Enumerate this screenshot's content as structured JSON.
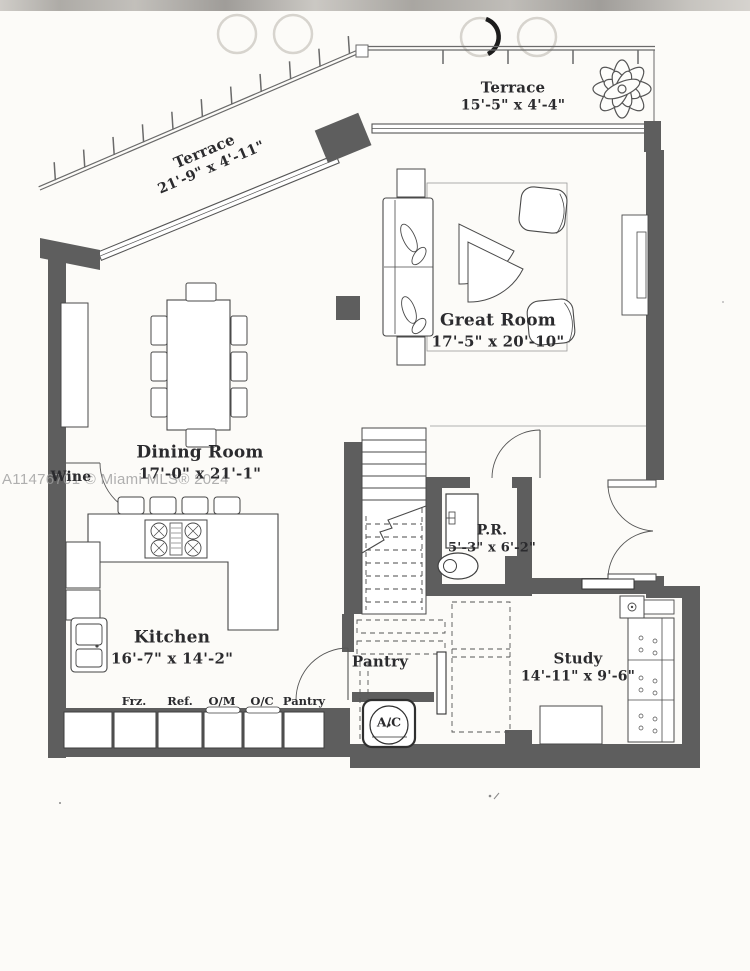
{
  "watermark": "A11476701 © Miami MLS® 2024",
  "rooms": {
    "terrace_top": {
      "name": "Terrace",
      "dims": "15'-5\" x 4'-4\""
    },
    "terrace_side": {
      "name": "Terrace",
      "dims": "21'-9\" x 4'-11\""
    },
    "great_room": {
      "name": "Great Room",
      "dims": "17'-5\" x 20'-10\""
    },
    "dining_room": {
      "name": "Dining Room",
      "dims": "17'-0\" x 21'-1\""
    },
    "kitchen": {
      "name": "Kitchen",
      "dims": "16'-7\" x 14'-2\""
    },
    "powder_room": {
      "name": "P.R.",
      "dims": "5'-3\" x 6'-2\""
    },
    "pantry": {
      "name": "Pantry"
    },
    "study": {
      "name": "Study",
      "dims": "14'-11\" x 9'-6\""
    },
    "wine_bar": {
      "name": "Wine"
    }
  },
  "fixtures": {
    "freezer": "Frz.",
    "refrigerator": "Ref.",
    "oven_microwave": "O/M",
    "oven_convection": "O/C",
    "pantry_cabinet": "Pantry",
    "air_conditioner": "A/C"
  },
  "colors": {
    "wall": "#5e5e5e",
    "line": "#4a4a4a",
    "page": "#fcfbf8",
    "watermark": "#9d9d9d"
  }
}
